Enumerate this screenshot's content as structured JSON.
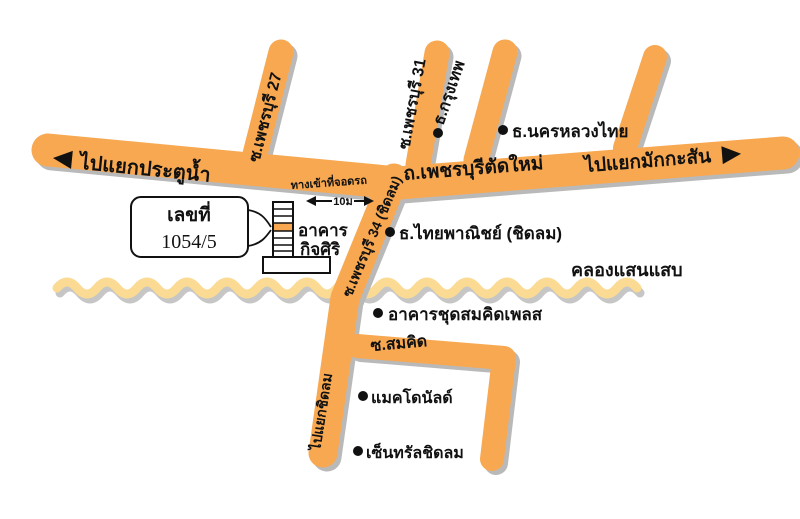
{
  "theme": {
    "road": "#F7A851",
    "road-shadow": "#B9B9B9",
    "canal": "#FBDB93",
    "canal-shadow": "#C6C6C6",
    "ink": "#111111"
  },
  "map": {
    "main_road": {
      "to_left": "ไปแยกประตูน้ำ",
      "name": "ถ.เพชรบุรีตัดใหม่",
      "to_right": "ไปแยกมักกะสัน"
    },
    "sois": {
      "phetchaburi27": "ซ.เพชรบุรี 27",
      "phetchaburi31": "ซ.เพชรบุรี 31",
      "phetchaburi34": "ซ.เพชรบุรี 34 (ชิดลม)",
      "to_chitlom": "ไปแยกชิดลม",
      "somkid": "ซ.สมคิด"
    },
    "canal_label": "คลองแสนแสบ",
    "pois": {
      "bangkok_bank": "ธ.กรุงเทพ",
      "nakornluang_bank": "ธ.นครหลวงไทย",
      "scb_chitlom": "ธ.ไทยพาณิชย์ (ชิดลม)",
      "somkid_place": "อาคารชุดสมคิดเพลส",
      "mcdonalds": "แมคโดนัลด์",
      "central_chitlom": "เซ็นทรัลชิดลม"
    },
    "building": {
      "callout_line1": "เลขที่",
      "callout_line2": "1054/5",
      "name_line1": "อาคาร",
      "name_line2": "กิจศิริ"
    },
    "parking": {
      "entrance": "ทางเข้าที่จอดรถ",
      "distance": "10ม"
    }
  }
}
